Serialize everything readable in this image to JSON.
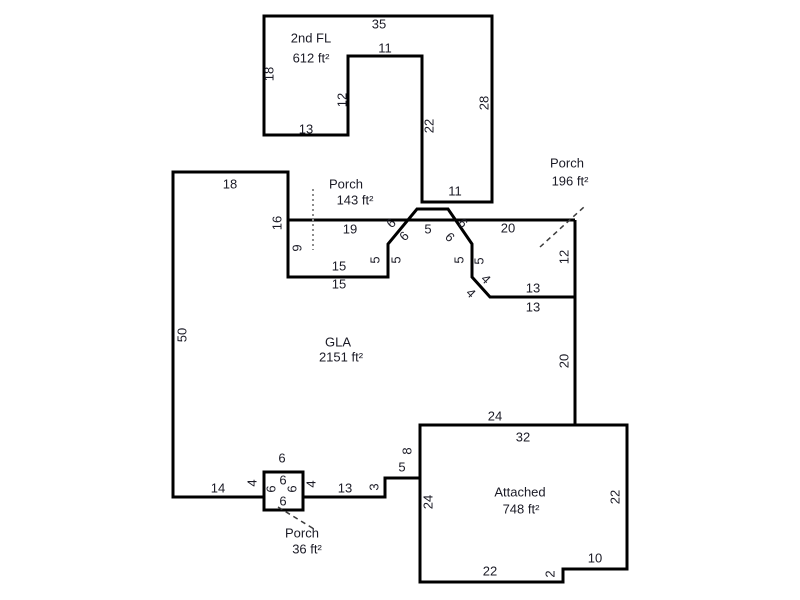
{
  "sketch": {
    "colors": {
      "background": "#ffffff",
      "wall_line": "#000000",
      "label_text": "#1b1b26",
      "porch_divider_dotted": "#8c8c8c",
      "porch_leader_dashed": "#3c3c3c"
    },
    "units": {
      "second_floor": {
        "name": "2nd FL",
        "area": "612 ft²",
        "dims": {
          "top": "35",
          "notch_top": "11",
          "left": "18",
          "inner_left": "12",
          "bottom_left": "13",
          "inner_right": "22",
          "right": "28",
          "bottom": "11"
        }
      },
      "gla": {
        "name": "GLA",
        "area": "2151 ft²",
        "dims": {
          "top": "18",
          "upper_left": "16",
          "left": "50",
          "bottom_left": "14",
          "porch_gap_left": "4",
          "porch_gap_right": "4",
          "bottom_mid": "13",
          "step_up": "3",
          "step_over": "5",
          "step_side": "8",
          "bottom_right": "24",
          "right": "20",
          "ledge_outer": "13",
          "ledge_inner": "13",
          "porch_rear_right": "12",
          "porch_rear_top": "20",
          "bay_top": "5",
          "bay_diag_left_outer": "6",
          "bay_diag_left_inner": "6",
          "bay_diag_right_outer": "6",
          "bay_diag_right_inner": "6",
          "bay_side_left_outer": "5",
          "bay_side_left_inner": "5",
          "bay_side_right_outer": "5",
          "bay_side_right_inner": "5",
          "corner_diag_outer": "4",
          "corner_diag_inner": "4",
          "porch_main_top": "19",
          "porch_main_left": "9",
          "porch_main_bottom_inner": "15",
          "porch_main_bottom_outer": "15"
        }
      },
      "porch_main": {
        "name": "Porch",
        "area": "143 ft²"
      },
      "porch_rear": {
        "name": "Porch",
        "area": "196 ft²"
      },
      "porch_entry": {
        "name": "Porch",
        "area": "36 ft²",
        "dims": {
          "top": "6",
          "inner_top": "6",
          "inner_left": "6",
          "inner_right": "6",
          "inner_bottom": "6"
        }
      },
      "attached": {
        "name": "Attached",
        "area": "748 ft²",
        "dims": {
          "top": "32",
          "left": "24",
          "right": "22",
          "bottom": "22",
          "notch_side": "2",
          "notch_top": "10"
        }
      }
    }
  }
}
